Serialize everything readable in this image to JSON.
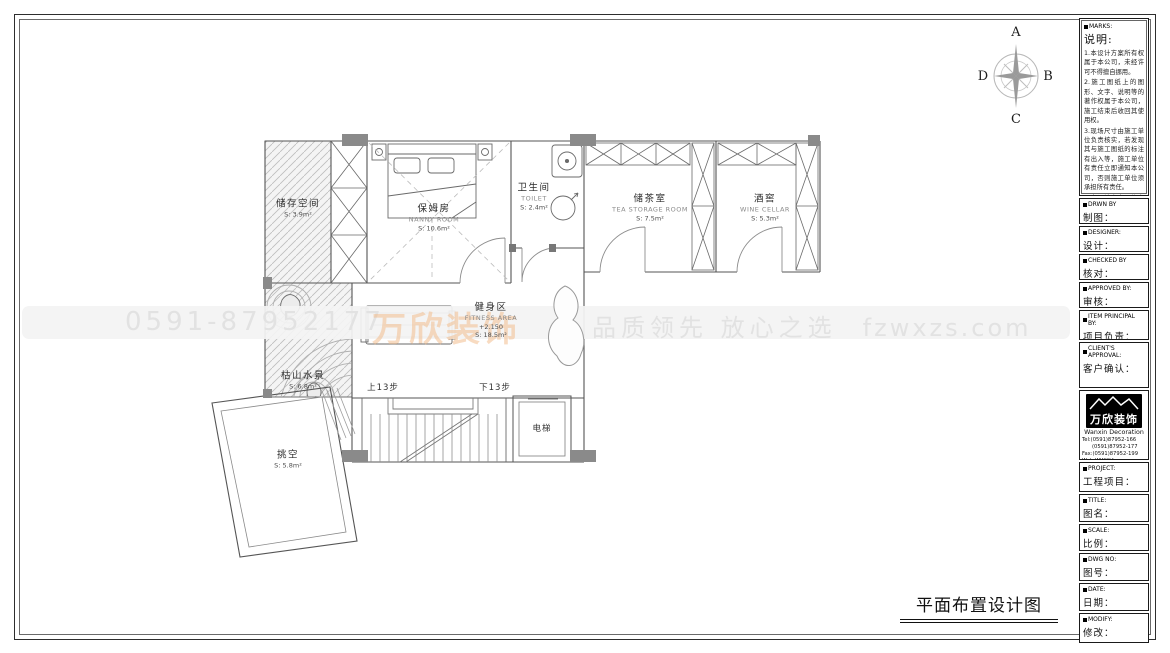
{
  "compass": {
    "north": "A",
    "east": "B",
    "south": "C",
    "west": "D"
  },
  "watermark": {
    "phone": "0591-87952177",
    "slogan": "品质领先 放心之选",
    "website": "fzwxzs.com",
    "logo_text": "万欣装饰"
  },
  "drawing_title": "平面布置设计图",
  "rooms": {
    "storage": {
      "zh": "储存空间",
      "area": "S: 3.9m²"
    },
    "nanny": {
      "zh": "保姆房",
      "en": "NANNY ROOM",
      "area": "S: 10.6m²"
    },
    "toilet": {
      "zh": "卫生间",
      "en": "TOILET",
      "area": "S: 2.4m²"
    },
    "tea": {
      "zh": "储茶室",
      "en": "TEA STORAGE ROOM",
      "area": "S: 7.5m²"
    },
    "wine": {
      "zh": "酒窖",
      "en": "WINE CELLAR",
      "area": "S: 5.3m²"
    },
    "fitness": {
      "zh": "健身区",
      "en": "FITNESS AREA",
      "level": "+2.150",
      "area": "S: 18.5m²"
    },
    "zen": {
      "zh": "枯山水景",
      "area": "S: 6.8m²"
    },
    "void": {
      "zh": "挑空",
      "area": "S: 5.8m²"
    }
  },
  "annotations": {
    "stair_up": "上13步",
    "stair_down": "下13步",
    "elevator": "电梯"
  },
  "sidebar": {
    "marks": {
      "en": "MARKS:",
      "zh_title": "说明:"
    },
    "notes": [
      "1.本设计方案所有权属于本公司，未经许可不得擅自挪用。",
      "2.施工图纸上的图形、文字、说明等的著作权属于本公司，施工结束后收回其使用权。",
      "3.现场尺寸由施工单位负责核实，若发现其与施工图纸的标注有出入等，施工单位有责任立即通知本公司，否则施工单位须承担所有责任。",
      "4.本设计方案是依客户要求设计，经客户签字即视为同意认可，不得随意更改。"
    ],
    "fields": [
      {
        "en": "DRWN BY",
        "zh": "制图："
      },
      {
        "en": "DESIGNER:",
        "zh": "设计："
      },
      {
        "en": "CHECKED BY",
        "zh": "核对："
      },
      {
        "en": "APPROVED BY:",
        "zh": "审核："
      },
      {
        "en": "ITEM PRINCIPAL BY:",
        "zh": "项目负责："
      },
      {
        "en": "CLIENT'S APPROVAL:",
        "zh": "客户确认："
      }
    ],
    "company": {
      "logo_zh": "万欣装饰",
      "logo_en": "Wanxin Decoration",
      "tel1": "Tel:(0591)87952-166",
      "tel2": "(0591)87952-177",
      "fax": "Fax:(0591)87952-199",
      "web": "Web:WWW.fzwxzs.com"
    },
    "fields2": [
      {
        "en": "PROJECT:",
        "zh": "工程项目："
      },
      {
        "en": "TITLE:",
        "zh": "图名："
      },
      {
        "en": "SCALE:",
        "zh": "比例："
      },
      {
        "en": "DWG NO:",
        "zh": "图号："
      },
      {
        "en": "DATE:",
        "zh": "日期："
      },
      {
        "en": "MODIFY:",
        "zh": "修改："
      }
    ]
  }
}
